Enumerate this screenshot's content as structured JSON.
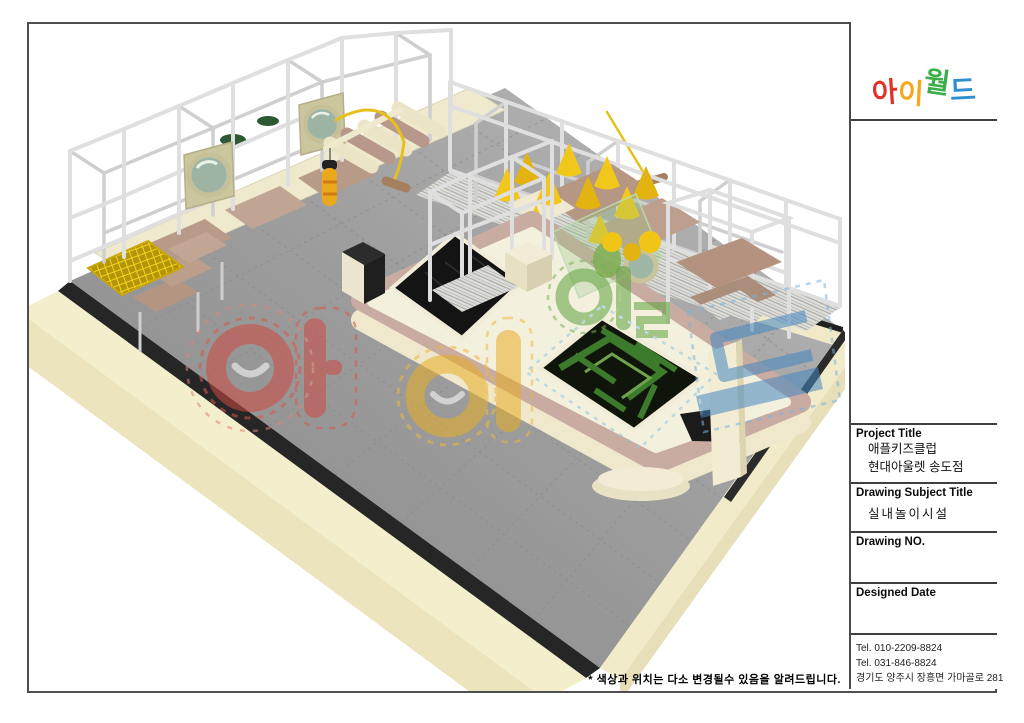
{
  "logo": {
    "text": "아이월드",
    "letters": [
      {
        "char": "아",
        "color": "#e23228"
      },
      {
        "char": "이",
        "color": "#f4a81d"
      },
      {
        "char": "월",
        "color": "#3cae49"
      },
      {
        "char": "드",
        "color": "#2f8fd0"
      }
    ]
  },
  "title_block": {
    "project_title_label": "Project Title",
    "project_title_lines": [
      "애플키즈클럽",
      "현대아울렛 송도점"
    ],
    "drawing_subject_label": "Drawing Subject Title",
    "drawing_subject": "실내놀이시설",
    "drawing_no_label": "Drawing NO.",
    "designed_date_label": "Designed Date",
    "contact_lines": [
      "Tel. 010-2209-8824",
      "Tel. 031-846-8824",
      "경기도 양주시 장흥면 가마골로 281"
    ]
  },
  "footer_note": "* 색상과 위치는 다소 변경될수 있음을 알려드립니다.",
  "scene": {
    "watermark_text": "아이월드",
    "colors": {
      "floor_gray": "#9c9c9c",
      "wall_cream": "#f3eecb",
      "wall_trim_black": "#262626",
      "island_band_pink": "#c8aba1",
      "deck_cream": "#f4f0de",
      "frame_white": "#dfdfdf",
      "equipment_yellow": "#f2c71b",
      "platform_brown": "#b59784",
      "maze_green": "#3c7a2c",
      "pit_black": "#141414",
      "watermark_red": "#cf4a42",
      "watermark_yellow": "#e8ae25",
      "watermark_green": "#5da23c",
      "watermark_blue": "#4587c0"
    }
  }
}
